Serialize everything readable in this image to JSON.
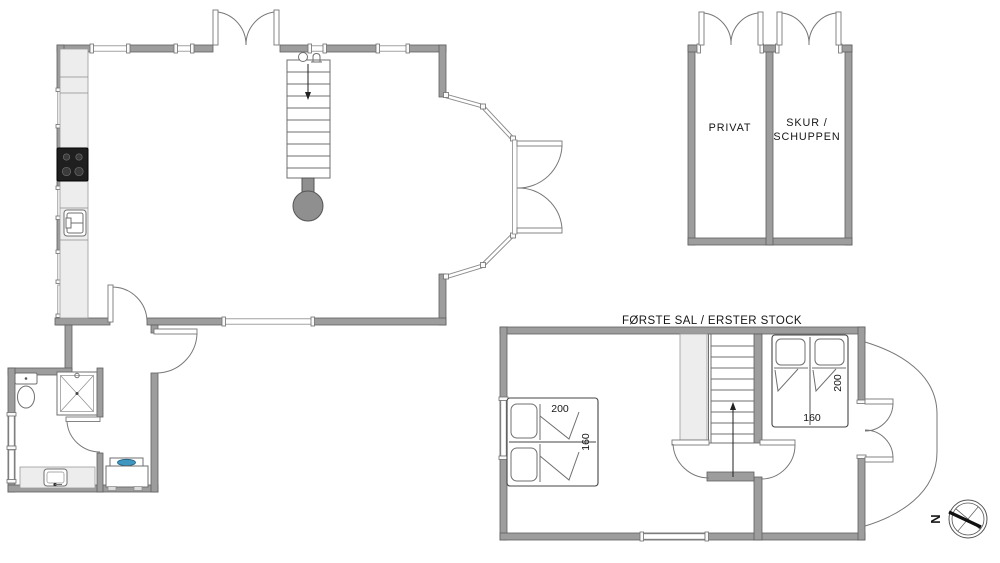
{
  "first_floor": {
    "title": "FØRSTE SAL / ERSTER STOCK",
    "bed_left": {
      "length": "200",
      "width": "160"
    },
    "bed_right": {
      "length": "200",
      "width": "160"
    }
  },
  "outbuilding": {
    "room1": "PRIVAT",
    "room2_line1": "SKUR /",
    "room2_line2": "SCHUPPEN"
  },
  "compass": {
    "north": "N"
  },
  "colors": {
    "wall": "#9d9d9d",
    "wall_outline": "#5f5f5f",
    "fixture_light": "#ededed",
    "stove": "#1f1f1f",
    "appliance_water": "#3f97c0",
    "line": "#6f6f6f",
    "text": "#161616",
    "background": "#ffffff"
  }
}
